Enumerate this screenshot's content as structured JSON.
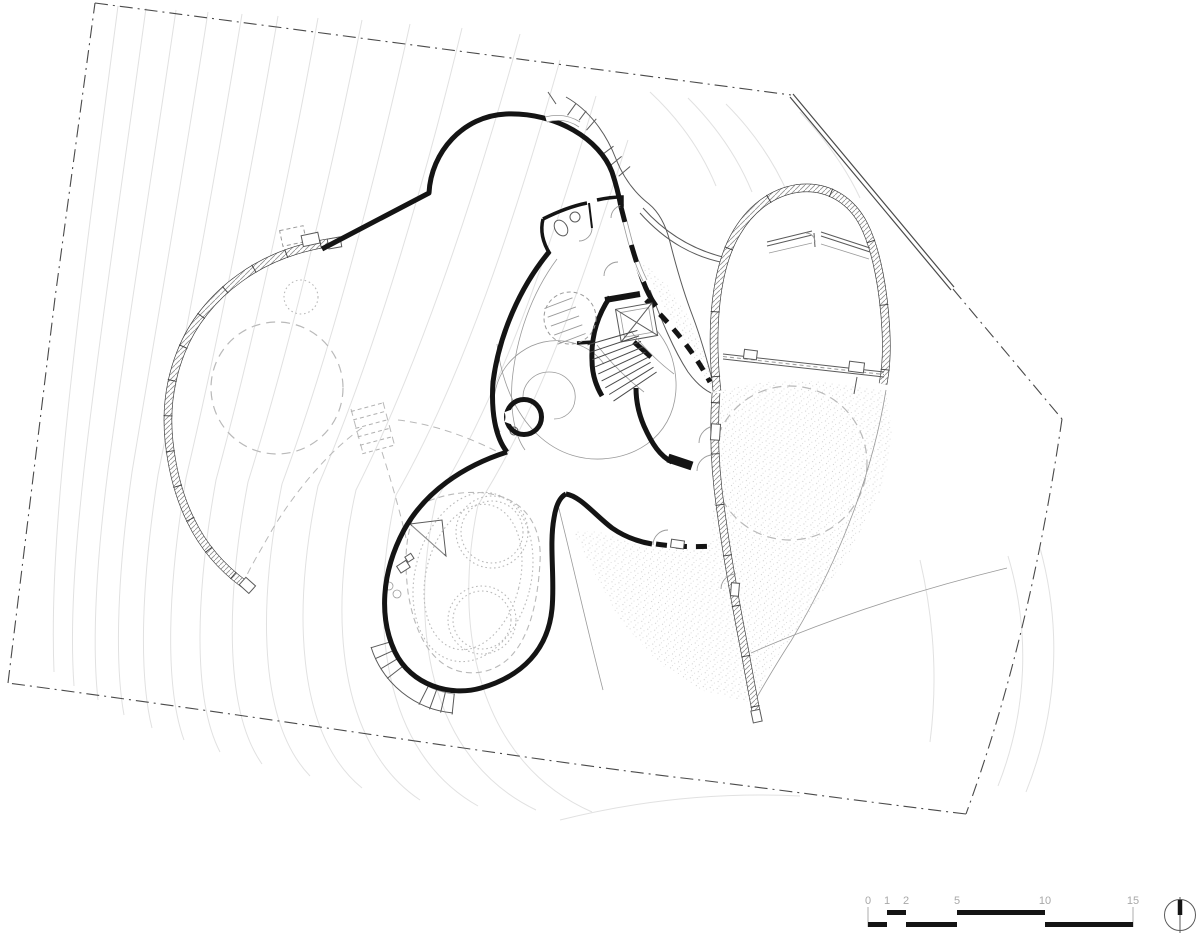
{
  "drawing": {
    "kind": "architectural site plan",
    "notes": "organic free-form building plan with contour lines, hatched retaining walls, stair core, pool terrace"
  },
  "scale_bar": {
    "unit_labels": [
      "0",
      "1",
      "2",
      "5",
      "10",
      "15"
    ]
  },
  "north_arrow": {
    "icon": "north-arrow-circle"
  },
  "colors": {
    "ink": "#141414",
    "wall": "#3a3a3a",
    "thin": "#5a5a5a",
    "faint": "#9a9a9a",
    "contour": "#e1e1e1",
    "dash": "#b9b9b9",
    "boundary": "#4a4a4a",
    "stipple": "#c6c6c6",
    "scale_text": "#a8a8a8",
    "paper": "#ffffff"
  }
}
